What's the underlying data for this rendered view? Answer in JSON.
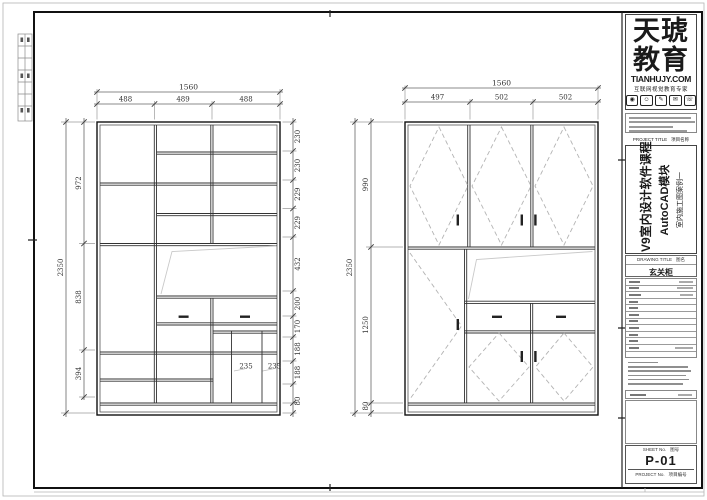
{
  "left_drawing": {
    "top_total": "1560",
    "top_segments": [
      "488",
      "489",
      "488"
    ],
    "side_total": "2350",
    "side_segments": [
      "972",
      "838",
      "394"
    ],
    "right_segments": [
      "230",
      "230",
      "229",
      "229",
      "432",
      "200",
      "170",
      "188",
      "188",
      "80"
    ],
    "inner_labels": [
      "235",
      "235"
    ]
  },
  "right_drawing": {
    "top_total": "1560",
    "top_segments": [
      "497",
      "502",
      "502"
    ],
    "side_total": "2350",
    "side_segments": [
      "990",
      "1250",
      "80"
    ]
  },
  "title_block": {
    "brand": {
      "name1": "天琥",
      "name2": "教育",
      "domain": "TIANHUJY.COM",
      "tagline": "互联网视觉教育专家",
      "icons": [
        "◉",
        "☺",
        "✎",
        "✉",
        "☏"
      ]
    },
    "project_title_label": "PROJECT TITLE",
    "project_title_cn": "项目名称",
    "course": {
      "l1": "V9室内设计软件课程",
      "l2": "AutoCAD模块",
      "l3": "室内施工图案例一"
    },
    "drawing_title_label": "DRAWING TITLE",
    "drawing_title_cn": "图名",
    "drawing_title": "玄关柜",
    "sheet_no_label": "SHEET No.",
    "sheet_no_cn": "图号",
    "sheet_no": "P-01",
    "project_no_label": "PROJECT No.",
    "project_no_cn": "项目编号"
  }
}
